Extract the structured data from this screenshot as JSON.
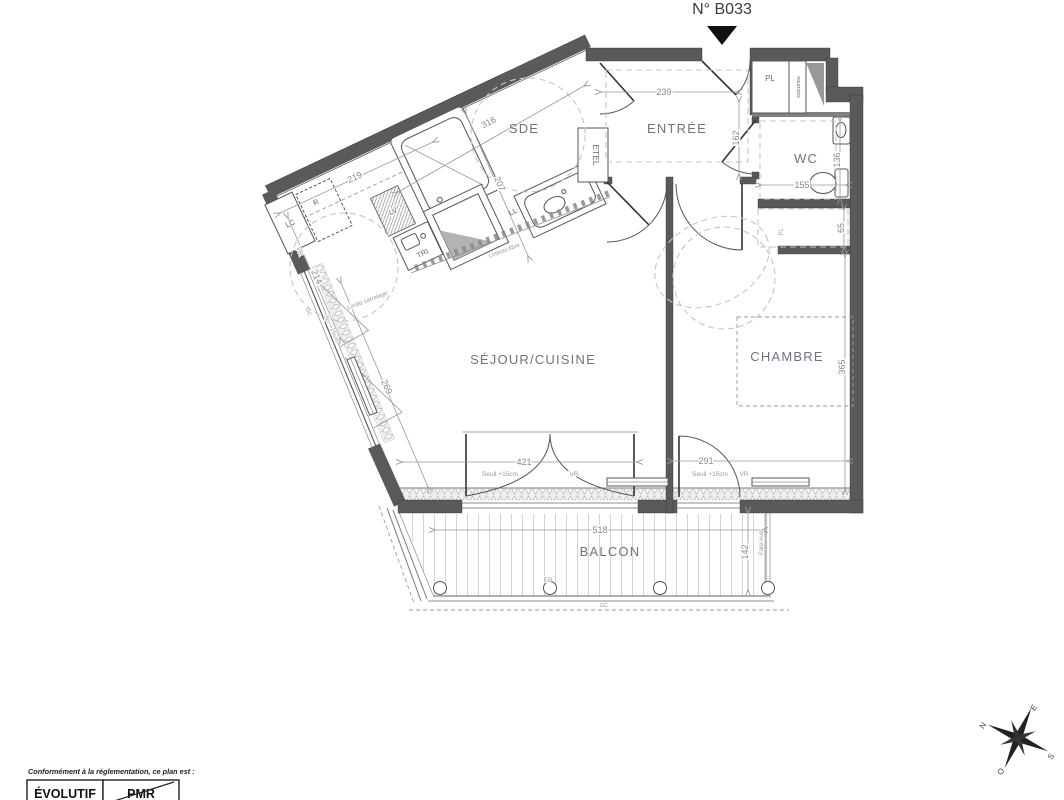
{
  "title": "N° B033",
  "rooms": {
    "sde": "SDE",
    "entree": "ENTRÉE",
    "wc": "WC",
    "sejour": "SÉJOUR/CUISINE",
    "chambre": "CHAMBRE",
    "balcon": "BALCON"
  },
  "dims": {
    "d239": "239",
    "d162": "162",
    "d316": "316",
    "d207": "207",
    "d219": "219",
    "d214": "214",
    "d136": "136",
    "d155": "155",
    "d65": "65",
    "d365": "365",
    "d291": "291",
    "d269": "269",
    "d421": "421",
    "d518": "518",
    "d142": "142"
  },
  "fixtures": {
    "pl": "PL",
    "pl2": "PL",
    "nourrices": "nourrices",
    "etel": "ETEL",
    "ll": "LL",
    "lv": "LV",
    "tri": "TRI",
    "lc": "LC",
    "r": "R",
    "ep": "EP",
    "gc": "GC",
    "gc2": "GC"
  },
  "annotations": {
    "seuil1": "Seuil +15cm",
    "vr1": "VR",
    "seuil2": "Seuil +15cm",
    "vr2": "VR",
    "vr_fen": "VR",
    "limite": "Limite carrelage",
    "linteau": "Linteau libre",
    "appui": "Ap. +25cm",
    "parevue": "Pare-vue"
  },
  "legend": {
    "intro": "Conformément à la réglementation, ce plan est :",
    "evolutif": "ÉVOLUTIF",
    "pmr": "PMR"
  },
  "compass": {
    "n": "N",
    "e": "E",
    "s": "S",
    "o": "O"
  }
}
